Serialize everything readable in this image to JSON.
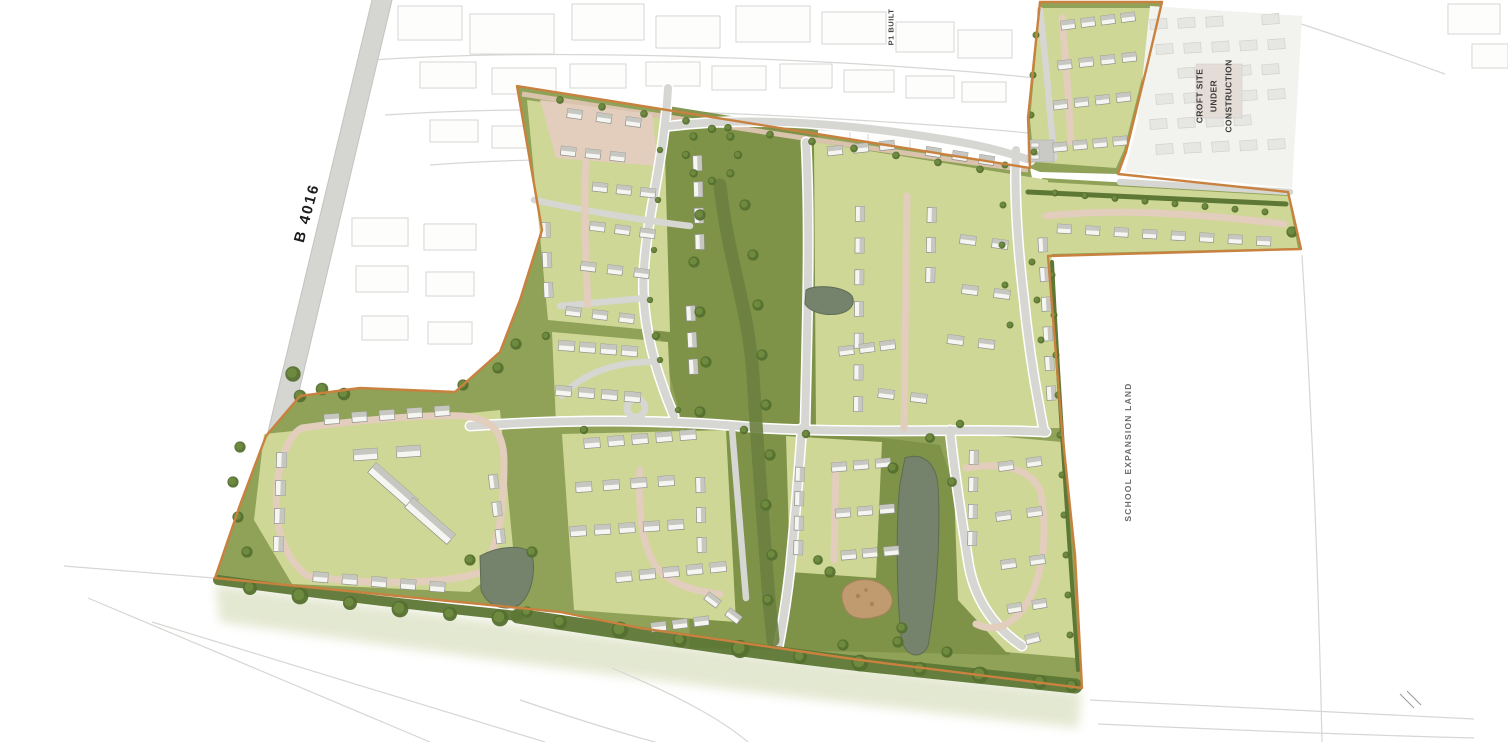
{
  "plan": {
    "labels": {
      "road": "B 4016",
      "p1": "P1 BUILT",
      "croft_line1": "CROFT SITE",
      "croft_line2": "UNDER",
      "croft_line3": "CONSTRUCTION",
      "school": "SCHOOL EXPANSION LAND"
    },
    "palette": {
      "background": "#ffffff",
      "parkland_green": "#8fa257",
      "corridor_green": "#7d9148",
      "swale_green": "#6b8040",
      "parcel_green": "#ced795",
      "tree_green": "#55702f",
      "road_grey": "#d6d6d2",
      "path_pink": "#e3cdbc",
      "house_white": "#f5f5f2",
      "roof_grey": "#c7c7c2",
      "pond_grey_green": "#76836c",
      "play_area_brown": "#c09b6f",
      "boundary_orange": "#c9813f",
      "existing_linework": "#d6d6d3"
    }
  }
}
